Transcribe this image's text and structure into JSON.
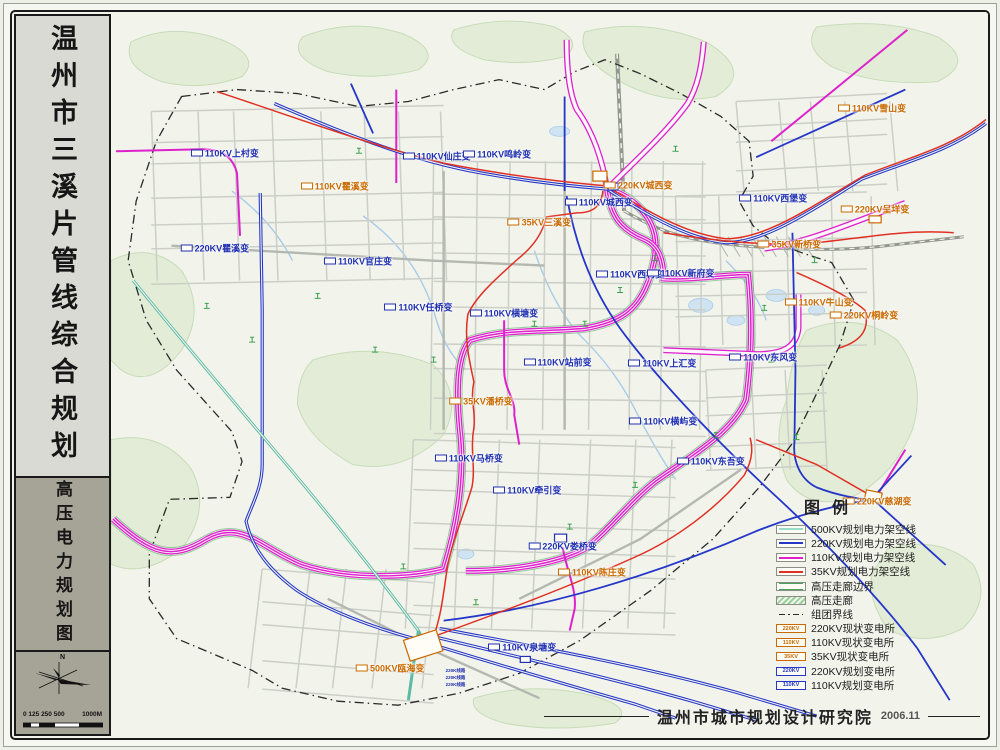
{
  "palette": {
    "kv500": "#5cbba6",
    "kv220": "#2536c8",
    "kv110": "#dd22cc",
    "kv35": "#e03024",
    "corridor": "#49a55c",
    "labelBlue": "#2030b0",
    "labelOrange": "#c96a00"
  },
  "sidebar": {
    "title": "温州市三溪片管线综合规划",
    "subtitle": "高压电力规划图",
    "compass_label": "N",
    "scale_numbers": "0 125 250 500",
    "scale_end": "1000M"
  },
  "legend": {
    "title": "图例",
    "items": [
      {
        "label": "500KV规划电力架空线",
        "symbol": "line",
        "color": "#9adcc9"
      },
      {
        "label": "220KV规划电力架空线",
        "symbol": "line",
        "color": "#2536c8"
      },
      {
        "label": "110KV规划电力架空线",
        "symbol": "line",
        "color": "#dd22cc"
      },
      {
        "label": "35KV规划电力架空线",
        "symbol": "line",
        "color": "#e03024"
      },
      {
        "label": "高压走廊边界",
        "symbol": "double",
        "color": "#49a55c"
      },
      {
        "label": "高压走廊",
        "symbol": "corridor",
        "color": "#49a55c"
      },
      {
        "label": "组团界线",
        "symbol": "dashdot",
        "color": "#2a2a2a"
      },
      {
        "label": "220KV现状变电所",
        "symbol": "station",
        "color": "#c96a00",
        "text": "220KV"
      },
      {
        "label": "110KV现状变电所",
        "symbol": "station",
        "color": "#c96a00",
        "text": "110KV"
      },
      {
        "label": "35KV现状变电所",
        "symbol": "station",
        "color": "#c96a00",
        "text": "35KV"
      },
      {
        "label": "220KV规划变电所",
        "symbol": "station",
        "color": "#2536c8",
        "text": "220KV"
      },
      {
        "label": "110KV规划变电所",
        "symbol": "station",
        "color": "#2536c8",
        "text": "110KV"
      }
    ]
  },
  "footer": {
    "org": "温州市城市规划设计研究院",
    "date": "2006.11"
  },
  "map": {
    "substations": [
      {
        "name": "110KV上村变",
        "color": "blue",
        "x": 113,
        "y": 142
      },
      {
        "name": "110KV瞿溪变",
        "color": "orange",
        "x": 222,
        "y": 175
      },
      {
        "name": "220KV瞿溪变",
        "color": "blue",
        "x": 103,
        "y": 237
      },
      {
        "name": "110KV官庄变",
        "color": "blue",
        "x": 245,
        "y": 250
      },
      {
        "name": "110KV任桥变",
        "color": "blue",
        "x": 305,
        "y": 297
      },
      {
        "name": "110KV仙庄变",
        "color": "blue",
        "x": 323,
        "y": 145
      },
      {
        "name": "110KV鸣岭变",
        "color": "blue",
        "x": 383,
        "y": 143
      },
      {
        "name": "220KV城西变",
        "color": "orange",
        "x": 523,
        "y": 174
      },
      {
        "name": "110KV城西变",
        "color": "blue",
        "x": 484,
        "y": 191
      },
      {
        "name": "35KV三溪变",
        "color": "orange",
        "x": 425,
        "y": 211
      },
      {
        "name": "110KV西村变",
        "color": "blue",
        "x": 515,
        "y": 263
      },
      {
        "name": "110KV新府变",
        "color": "blue",
        "x": 565,
        "y": 262
      },
      {
        "name": "110KV横塘变",
        "color": "blue",
        "x": 390,
        "y": 303
      },
      {
        "name": "110KV站前变",
        "color": "blue",
        "x": 443,
        "y": 352
      },
      {
        "name": "110KV上汇变",
        "color": "blue",
        "x": 547,
        "y": 353
      },
      {
        "name": "35KV潘桥变",
        "color": "orange",
        "x": 367,
        "y": 391
      },
      {
        "name": "110KV横屿变",
        "color": "blue",
        "x": 548,
        "y": 411
      },
      {
        "name": "110KV马桥变",
        "color": "blue",
        "x": 355,
        "y": 448
      },
      {
        "name": "110KV牵引变",
        "color": "blue",
        "x": 413,
        "y": 481
      },
      {
        "name": "220KV娄桥变",
        "color": "blue",
        "x": 448,
        "y": 537
      },
      {
        "name": "110KV陈庄变",
        "color": "orange",
        "x": 477,
        "y": 563
      },
      {
        "name": "110KV泉塘变",
        "color": "blue",
        "x": 408,
        "y": 638
      },
      {
        "name": "500KV瓯海变",
        "color": "orange",
        "x": 277,
        "y": 660
      },
      {
        "name": "110KV雪山变",
        "color": "orange",
        "x": 755,
        "y": 97
      },
      {
        "name": "110KV西堡变",
        "color": "blue",
        "x": 657,
        "y": 187
      },
      {
        "name": "220KV呈垟变",
        "color": "orange",
        "x": 758,
        "y": 198
      },
      {
        "name": "35KV新桥变",
        "color": "orange",
        "x": 673,
        "y": 233
      },
      {
        "name": "110KV牛山变",
        "color": "orange",
        "x": 702,
        "y": 292
      },
      {
        "name": "220KV桐岭变",
        "color": "orange",
        "x": 747,
        "y": 305
      },
      {
        "name": "110KV东风变",
        "color": "blue",
        "x": 647,
        "y": 347
      },
      {
        "name": "110KV东吾变",
        "color": "blue",
        "x": 595,
        "y": 451
      },
      {
        "name": "220KV慈湖变",
        "color": "orange",
        "x": 760,
        "y": 492
      }
    ],
    "route_notes": [
      "220K线路",
      "220K线路",
      "220K线路"
    ],
    "view": {
      "w": 870,
      "h": 730
    }
  }
}
